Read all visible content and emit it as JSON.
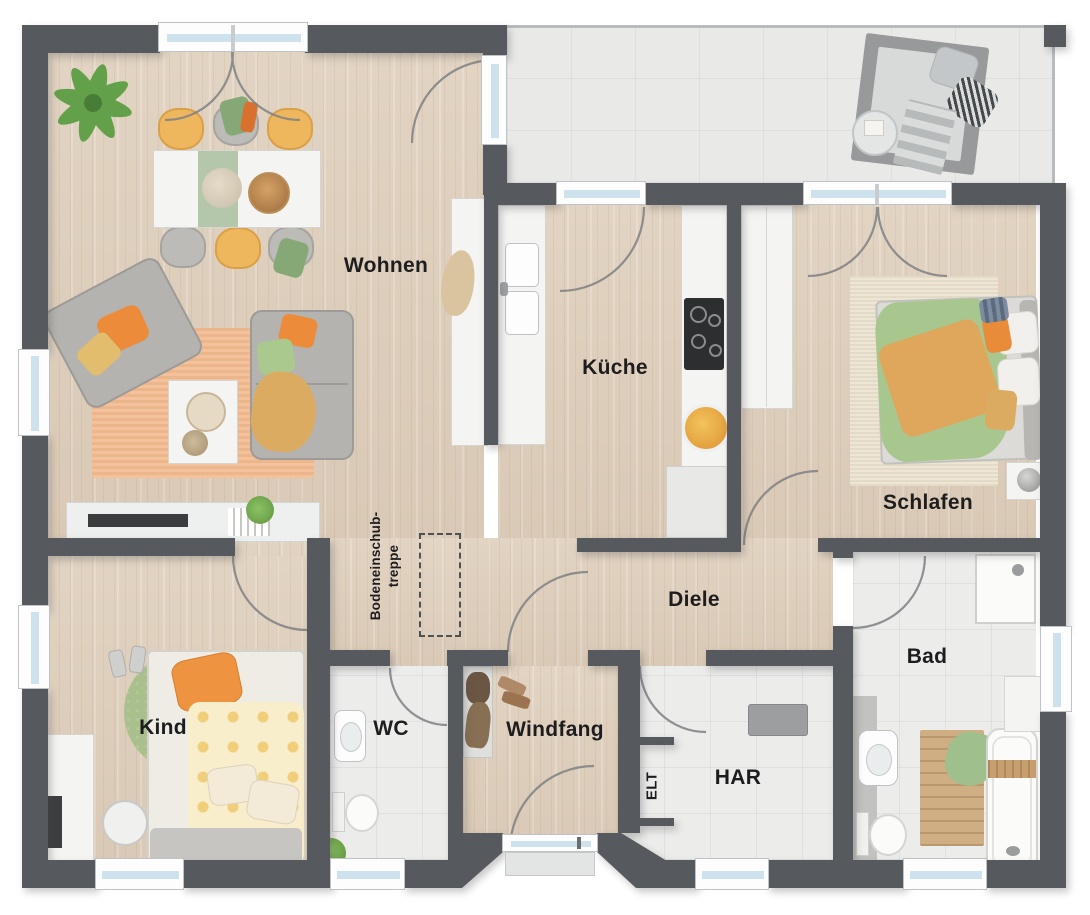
{
  "rooms": {
    "wohnen": {
      "label": "Wohnen"
    },
    "kueche": {
      "label": "Küche"
    },
    "schlafen": {
      "label": "Schlafen"
    },
    "diele": {
      "label": "Diele"
    },
    "bad": {
      "label": "Bad"
    },
    "kind": {
      "label": "Kind"
    },
    "wc": {
      "label": "WC"
    },
    "windfang": {
      "label": "Windfang"
    },
    "har": {
      "label": "HAR"
    },
    "elt": {
      "label": "ELT"
    },
    "attic_stairs": {
      "line1": "Bodeneinschub-",
      "line2": "treppe"
    }
  },
  "colors": {
    "wall": "#565a5e",
    "wood_floor": "#dccdbb",
    "tile_floor": "#ececeb",
    "accent_orange": "#ec8c3a",
    "accent_green": "#a9c48e",
    "accent_yellow": "#eeb757",
    "glass": "#cde2ec",
    "label_text": "#1d1d1f"
  }
}
